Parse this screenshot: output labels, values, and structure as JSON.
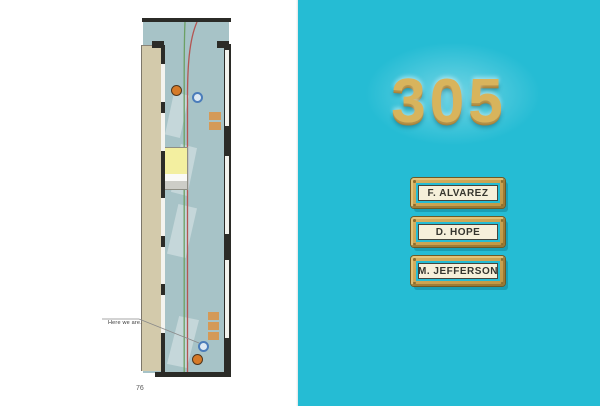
{
  "book": {
    "left_page": {
      "annotation": "Here we are.",
      "page_number": "76",
      "map": {
        "markers": [
          {
            "id": "orange-dot-top",
            "color": "#d67a28"
          },
          {
            "id": "blue-dot-top",
            "color": "#4a7cba"
          },
          {
            "id": "blue-dot-bottom",
            "color": "#4a7cba"
          },
          {
            "id": "orange-dot-bottom",
            "color": "#d67a28"
          }
        ],
        "path_colors": {
          "green": "#6ca064",
          "red": "#b45552"
        }
      }
    },
    "right_page": {
      "room_number": "305",
      "nameplates": [
        {
          "name": "F. ALVAREZ"
        },
        {
          "name": "D. HOPE"
        },
        {
          "name": "M. JEFFERSON"
        }
      ]
    },
    "colors": {
      "page_teal": "#25bcd4",
      "gold": "#d8b45c",
      "gold_dark": "#a6813a",
      "plate_cream": "#f6f0da",
      "corridor": "#a7c3c7",
      "wall_tan": "#d3caab",
      "wall_black": "#2b2b27",
      "room_yellow": "#f3efa0",
      "bench_tan": "#d49a58"
    }
  }
}
